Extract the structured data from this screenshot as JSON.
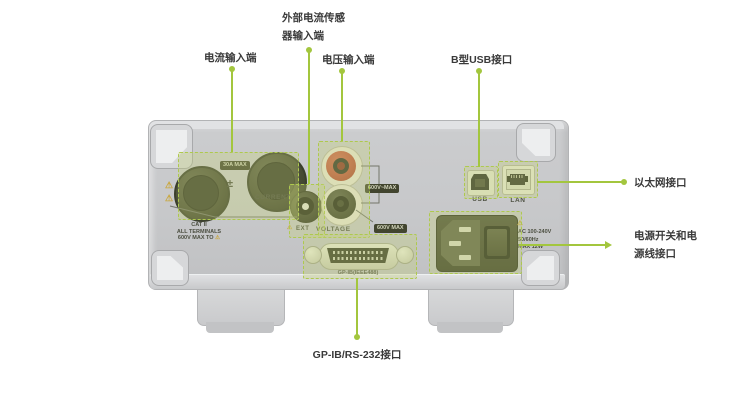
{
  "accent_color": "#a3c63e",
  "highlight_color": "#aec94e",
  "callouts": {
    "sensor": {
      "line1": "外部电流传感",
      "line2": "器输入端"
    },
    "current": {
      "label": "电流输入端"
    },
    "voltage": {
      "label": "电压输入端"
    },
    "usb": {
      "label": "B型USB接口"
    },
    "ethernet": {
      "label": "以太网接口"
    },
    "power": {
      "line1": "电源开关和电",
      "line2": "源线接口"
    },
    "gpib": {
      "label": "GP-IB/RS-232接口"
    }
  },
  "rear_panel": {
    "current": {
      "badge": "30A MAX",
      "polarity": "±",
      "label": "CURRENT",
      "rating": {
        "line1": "CAT II",
        "line2": "ALL TERMINALS",
        "line3": "600V MAX TO"
      }
    },
    "ext": {
      "label": "EXT"
    },
    "voltage": {
      "label": "VOLTAGE",
      "bracket_badge": "600V~MAX",
      "max_badge": "600V MAX"
    },
    "usb": {
      "label": "USB"
    },
    "lan": {
      "label": "LAN"
    },
    "gpib": {
      "label": "GP-IB(IEEE488)"
    },
    "power": {
      "line1": "AC 100-240V",
      "line2": "50/60Hz",
      "line3": "MAX 12W"
    },
    "warning_symbol": "⚠"
  }
}
